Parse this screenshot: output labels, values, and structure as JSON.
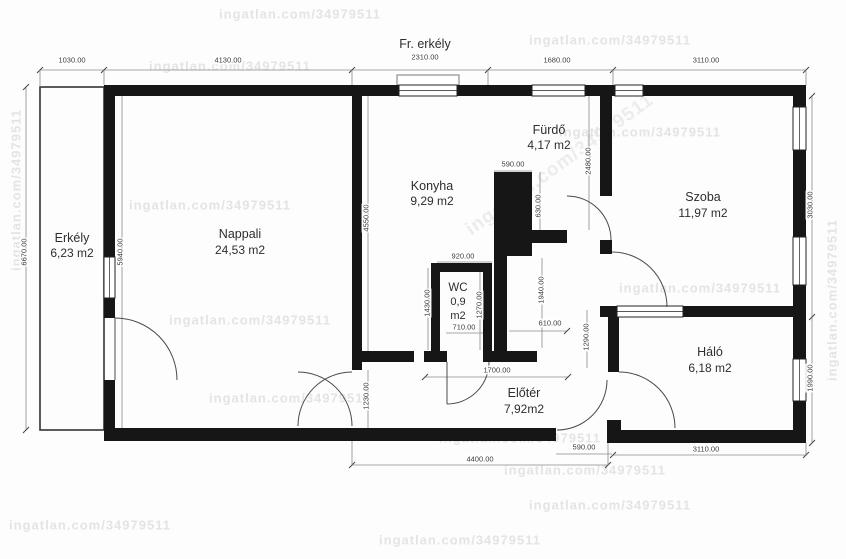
{
  "watermark": {
    "text": "ingatlan.com/34979511"
  },
  "rooms": {
    "erkely": {
      "name": "Erkély",
      "area": "6,23 m2"
    },
    "nappali": {
      "name": "Nappali",
      "area": "24,53 m2"
    },
    "konyha": {
      "name": "Konyha",
      "area": "9,29 m2"
    },
    "fr_erkely": {
      "name": "Fr. erkély"
    },
    "furdo": {
      "name": "Fürdő",
      "area": "4,17 m2"
    },
    "szoba": {
      "name": "Szoba",
      "area": "11,97 m2"
    },
    "wc": {
      "name": "WC",
      "area_line1": "0,9",
      "area_line2": "m2"
    },
    "eloter": {
      "name": "Előtér",
      "area": "7,92m2"
    },
    "halo": {
      "name": "Háló",
      "area": "6,18 m2"
    }
  },
  "dims": {
    "top_1030": "1030.00",
    "top_4130": "4130.00",
    "top_2310": "2310.00",
    "top_1680": "1680.00",
    "top_3110": "3110.00",
    "left_6670": "6670.00",
    "left_5940": "5940.00",
    "konyha_4550": "4550.00",
    "furdo_590": "590.00",
    "furdo_630": "630.00",
    "furdo_2480": "2480.00",
    "wc_920": "920.00",
    "wc_1430": "1430.00",
    "wc_1270": "1270.00",
    "wc_710": "710.00",
    "mid_610": "610.00",
    "mid_1940": "1940.00",
    "mid_1290": "1290.00",
    "eloter_1700": "1700.00",
    "eloter_1230": "1230.00",
    "bottom_4400": "4400.00",
    "entry_590": "590.00",
    "bottom_3110": "3110.00",
    "right_3030": "3030.00",
    "right_1990": "1990.00"
  },
  "colors": {
    "wall": "#161616",
    "dim": "#555555",
    "watermark": "#e4e4e4"
  }
}
